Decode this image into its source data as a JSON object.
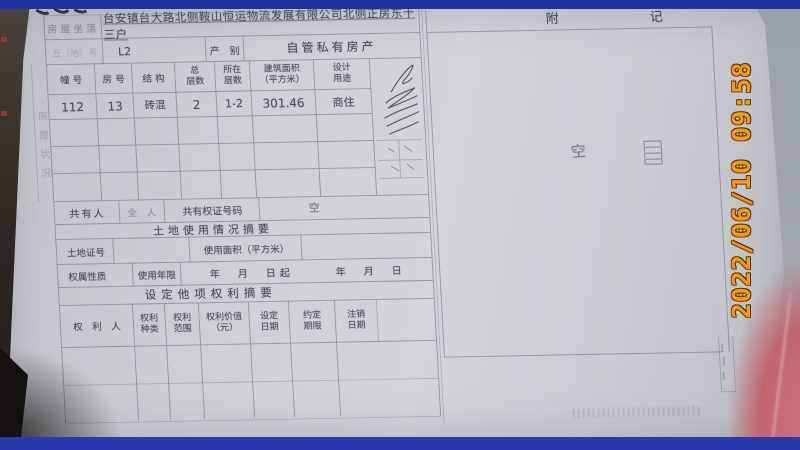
{
  "camera": {
    "timestamp": "2022/06/10 09:58",
    "timestamp_color": "#f09d15",
    "frame_color": "#2733a8"
  },
  "document": {
    "location_label": "房屋坐落",
    "location_value": "台安镇台大路北侧鞍山恒运物流发展有限公司北侧正房东十三户",
    "plot_label": "丘（地）号",
    "plot_value": "L2",
    "category_label": "产　别",
    "category_value": "自管私有房产",
    "building_table": {
      "headers": [
        "幢 号",
        "房 号",
        "结 构",
        "总\n层数",
        "所在\n层数",
        "建筑面积\n（平方米）",
        "设计\n用途"
      ],
      "values": [
        "112",
        "13",
        "砖混",
        "2",
        "1-2",
        "301.46",
        "商住"
      ]
    },
    "side_label": "房屋状况",
    "coowner": {
      "label": "共有人",
      "middle": "全　人",
      "cert_label": "共有权证号码",
      "value": "空"
    },
    "land": {
      "heading": "土地使用情况摘要",
      "cert_label": "土地证号",
      "area_label": "使用面积（平方米）",
      "nature_label": "权属性质",
      "term_label": "使用年限",
      "term_value": "年　月　日起　　　年　月　日"
    },
    "rights": {
      "heading": "设定他项权利摘要",
      "headers": [
        "权　利　人",
        "权利\n种类",
        "权利\n范围",
        "权利价值\n（元）",
        "设定\n日期",
        "约定\n期限",
        "注销\n日期"
      ]
    },
    "notes": {
      "heading": "附　　　　　　　记",
      "handwritten_mark": "空"
    }
  }
}
